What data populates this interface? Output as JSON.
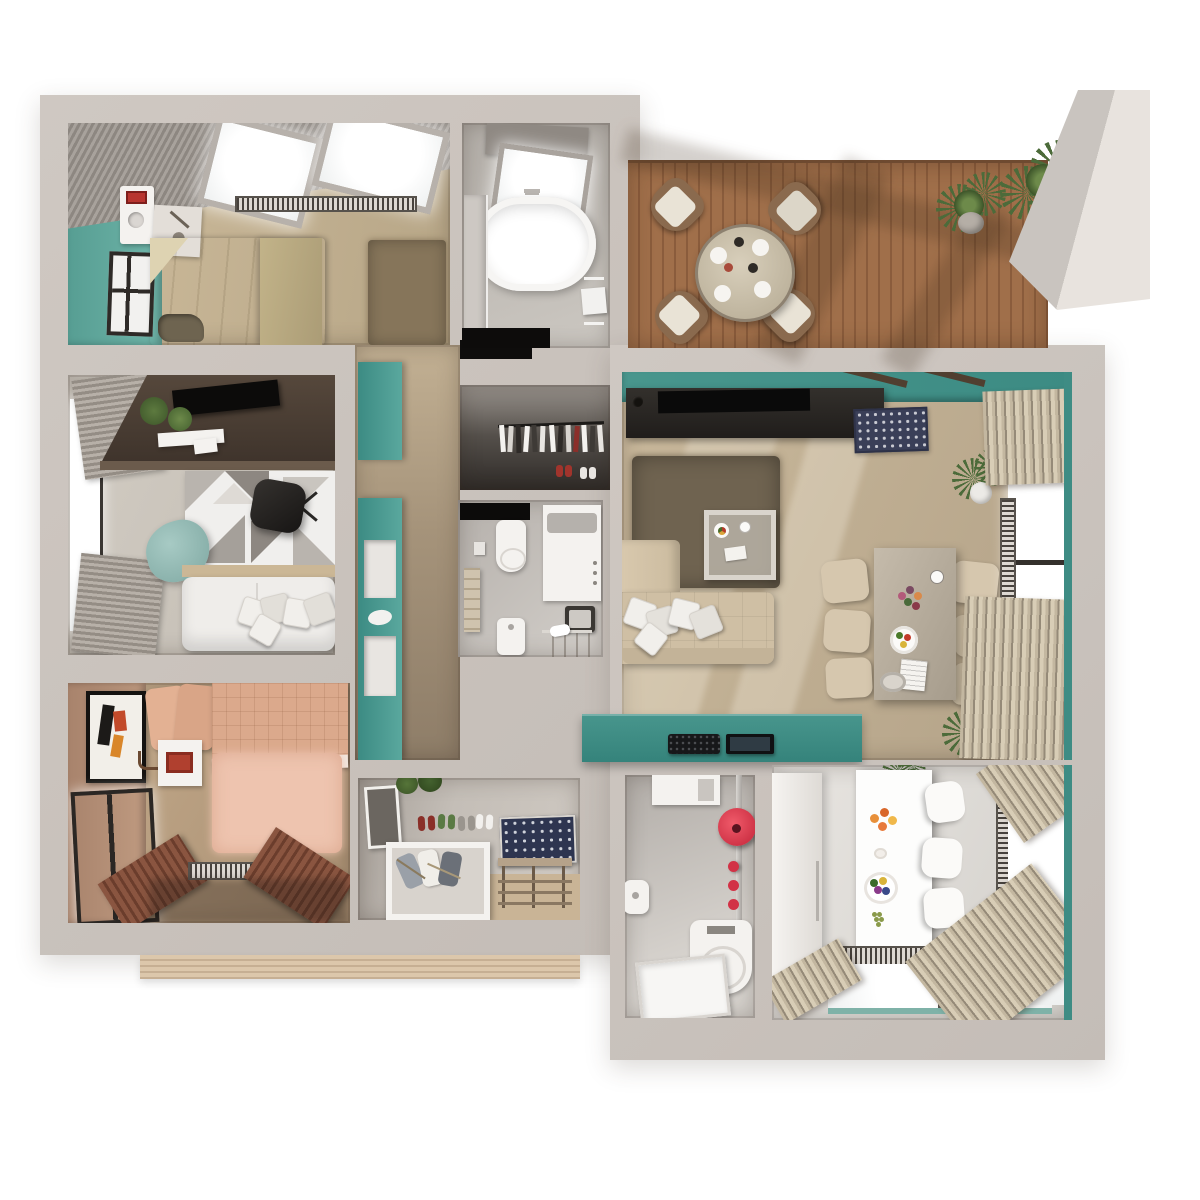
{
  "scene": {
    "kind": "3d-floor-plan-render",
    "view": "top-down",
    "background": "#ffffff",
    "text_visible": false
  },
  "colors": {
    "wall": "#cfc8c2",
    "wallEdge": "#b3aca6",
    "teal": "#4a968c",
    "tealDark": "#3c8b83",
    "tealWall": "#64ada1",
    "woodLight": "#cdbb9b",
    "woodMid": "#b7a687",
    "woodDark": "#8e7d68",
    "deck": "#9c6f4b",
    "deckDark": "#7e5538",
    "rugBrown": "#6f6350",
    "sofaBeige": "#cfbfa4",
    "bedKhaki": "#c9ba92",
    "quiltSalmon": "#dba98c",
    "rugPink": "#eec4af",
    "tanWall": "#b08a76",
    "consoleDark": "#2b2724",
    "accentRed": "#e23a50",
    "matNavy": "#3a3f58",
    "plant": "#4c6b3a",
    "tile": "#c6c1bb",
    "white": "#f4f2ef"
  },
  "rooms": [
    {
      "id": "bedroom-1",
      "name": "Bedroom 1 (top left)",
      "furniture": [
        "skylight-window",
        "skylight-window",
        "radiator",
        "bed",
        "rug",
        "side-table",
        "intercom-unit",
        "wall-window",
        "door-mat",
        "teal-accent-wall"
      ]
    },
    {
      "id": "bathroom-1",
      "name": "Bathroom 1 (top center)",
      "furniture": [
        "skylight-window",
        "bathtub",
        "towel-rack",
        "shelf-counter",
        "door-mat"
      ]
    },
    {
      "id": "terrace",
      "name": "Terrace (top right)",
      "furniture": [
        "round-dining-table",
        "terrace-chair",
        "terrace-chair",
        "terrace-chair",
        "terrace-chair",
        "potted-plant",
        "potted-plant",
        "concrete-wall"
      ]
    },
    {
      "id": "office-lounge",
      "name": "Office / lounge (middle left)",
      "furniture": [
        "window-blinds",
        "desk",
        "wall-tv",
        "desk-plants",
        "shelf",
        "geometric-rug",
        "office-chair",
        "bean-bag",
        "white-sofa",
        "pillows"
      ]
    },
    {
      "id": "hallway",
      "name": "Hallway (center)",
      "furniture": [
        "teal-partition-wall",
        "wall-niche",
        "wall-niche"
      ]
    },
    {
      "id": "wardrobe",
      "name": "Wardrobe closet (center top)",
      "furniture": [
        "clothes-rail",
        "hanging-clothes",
        "shoes"
      ]
    },
    {
      "id": "laundry-bath",
      "name": "Small bathroom / laundry (center)",
      "furniture": [
        "door-mat",
        "toilet",
        "washing-machine",
        "towel-ladder",
        "pedestal-sink",
        "bench",
        "towel-tray"
      ]
    },
    {
      "id": "living-dining",
      "name": "Living / dining room (right)",
      "furniture": [
        "tv-console",
        "tv",
        "patterned-door-mat",
        "shag-rug",
        "coffee-table",
        "chaise",
        "sofa",
        "pillows",
        "dining-table",
        "dining-chairs",
        "window",
        "curtains",
        "radiator",
        "plants",
        "teal-media-counter",
        "remote-controls"
      ]
    },
    {
      "id": "bedroom-2",
      "name": "Bedroom 2 (bottom left)",
      "furniture": [
        "bed",
        "pillows",
        "nightstand",
        "wall-art",
        "sconce",
        "fluffy-rug",
        "window",
        "slat-bench",
        "radiator"
      ]
    },
    {
      "id": "entry",
      "name": "Entry (bottom center)",
      "furniture": [
        "mirror",
        "hanging-plant",
        "slippers",
        "patterned-panel",
        "shoe-box",
        "sneakers",
        "bench"
      ]
    },
    {
      "id": "toilet-room",
      "name": "Toilet room (bottom center right)",
      "furniture": [
        "cabinet",
        "red-wall-disc",
        "red-dispensers",
        "pipe",
        "toilet",
        "sink",
        "shower-tray"
      ]
    },
    {
      "id": "kitchen",
      "name": "Kitchen (bottom right)",
      "furniture": [
        "fridge-cabinet",
        "island-counter",
        "fruit-plates",
        "bar-stool",
        "bar-stool",
        "bar-stool",
        "radiator",
        "window",
        "curtains",
        "plant"
      ]
    }
  ]
}
